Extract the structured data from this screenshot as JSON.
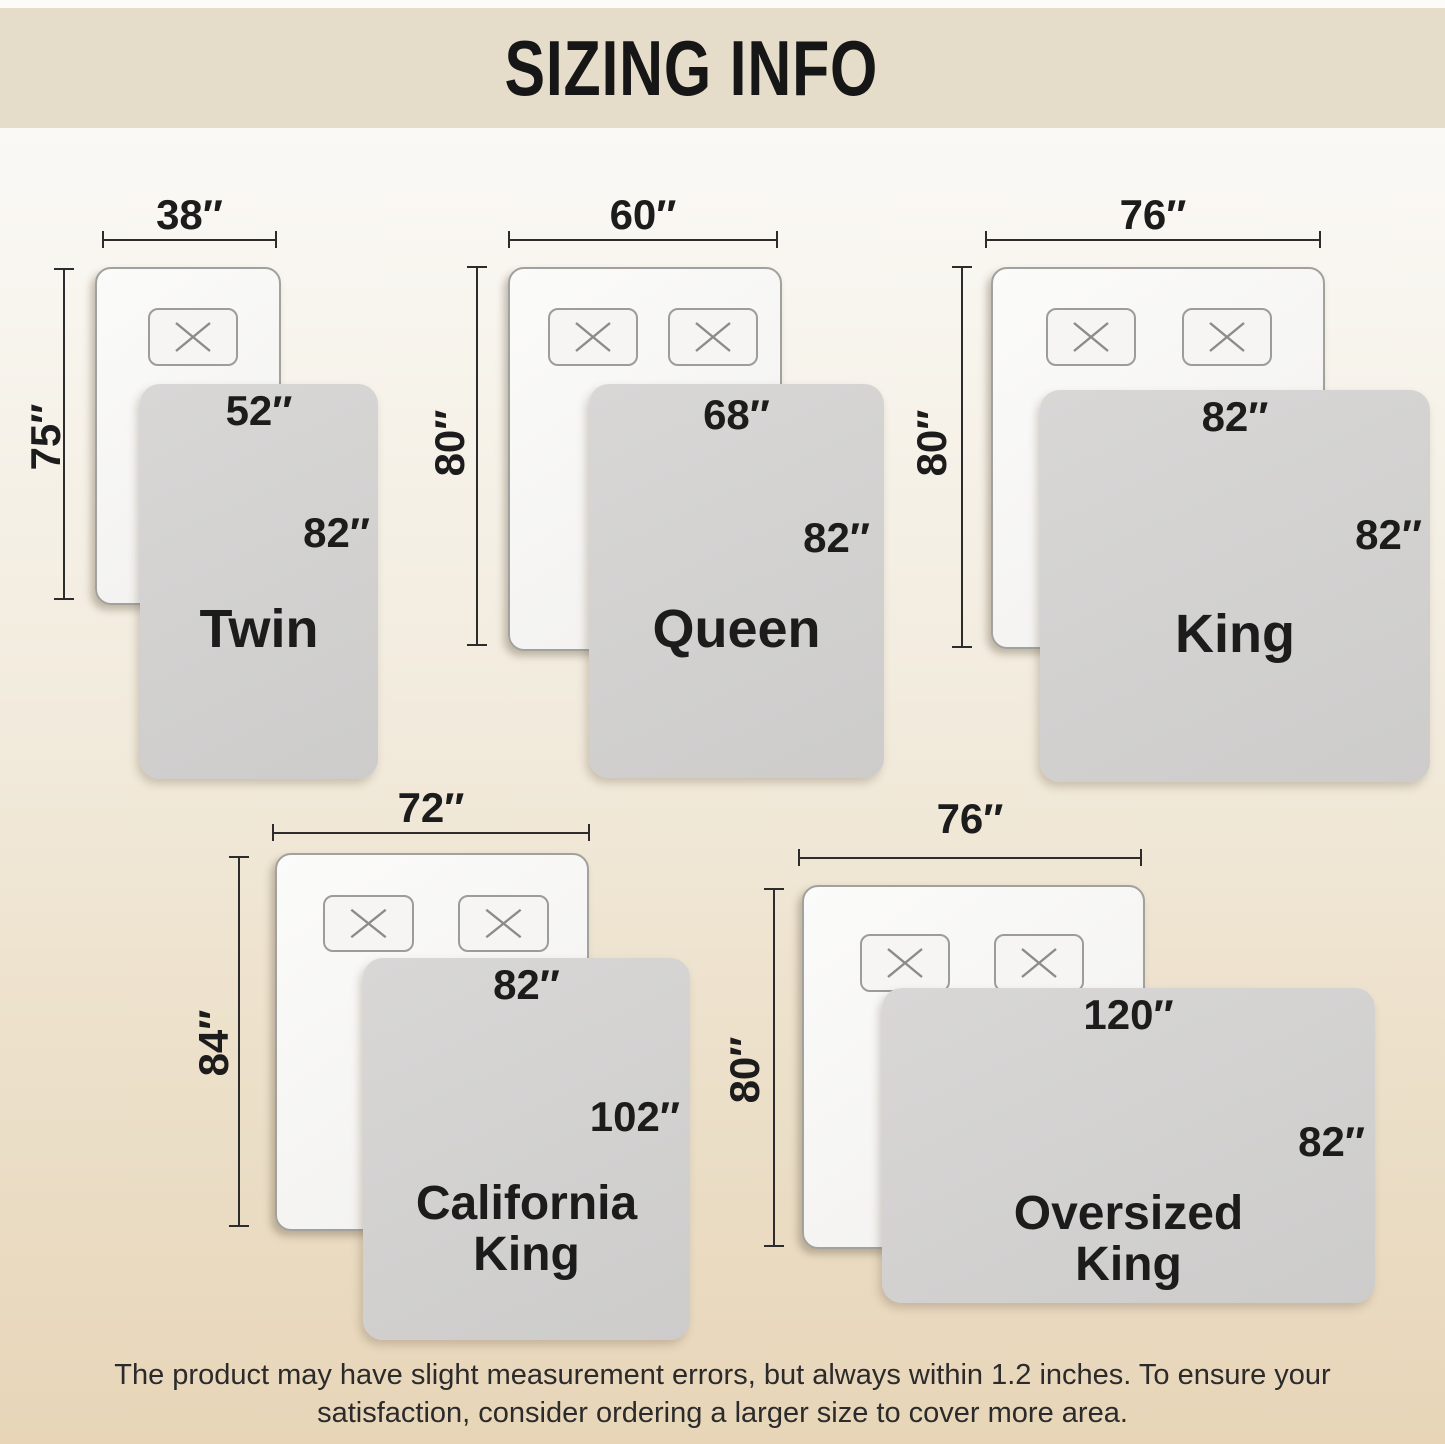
{
  "header": {
    "title": "SIZING INFO"
  },
  "beds": [
    {
      "name": "Twin",
      "mattress_width": "38″",
      "mattress_length": "75″",
      "blanket_width": "52″",
      "blanket_length": "82″",
      "pillows": 1
    },
    {
      "name": "Queen",
      "mattress_width": "60″",
      "mattress_length": "80″",
      "blanket_width": "68″",
      "blanket_length": "82″",
      "pillows": 2
    },
    {
      "name": "King",
      "mattress_width": "76″",
      "mattress_length": "80″",
      "blanket_width": "82″",
      "blanket_length": "82″",
      "pillows": 2
    },
    {
      "name": "California King",
      "mattress_width": "72″",
      "mattress_length": "84″",
      "blanket_width": "82″",
      "blanket_length": "102″",
      "pillows": 2
    },
    {
      "name": "Oversized King",
      "mattress_width": "76″",
      "mattress_length": "80″",
      "blanket_width": "120″",
      "blanket_length": "82″",
      "pillows": 2
    }
  ],
  "footer": {
    "line1": "The product may have slight measurement errors, but always within 1.2 inches. To ensure your",
    "line2": "satisfaction, consider ordering a larger size to cover more area."
  },
  "colors": {
    "header_bg": "#e5dcc9",
    "blanket_gray": "#d3d2d1",
    "background_bottom": "#e8d5b8",
    "text": "#1c1c1c"
  }
}
